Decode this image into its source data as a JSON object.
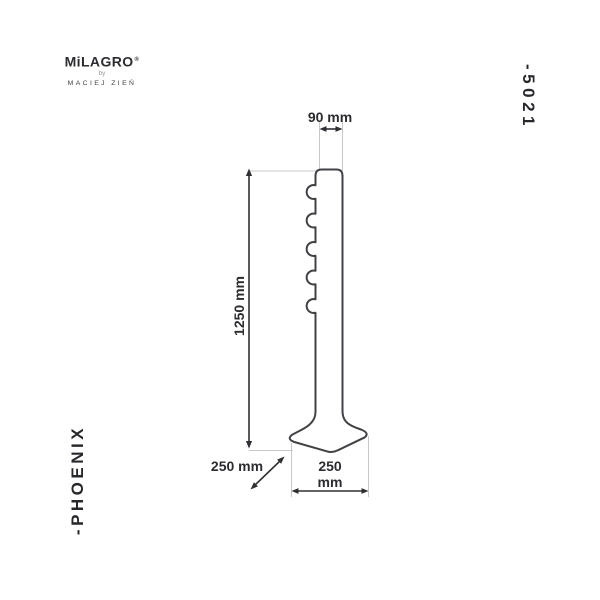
{
  "brand": {
    "name": "MiLAGRO",
    "registered": "®",
    "by": "by",
    "designer": "MACIEJ ZIEŃ"
  },
  "product": {
    "code": "-5021",
    "name": "-PHOENIX"
  },
  "drawing": {
    "type": "technical-dimension-drawing",
    "subject": "floor lamp pole with five side knobs and flared hexagonal base",
    "dim_top_width": "90 mm",
    "dim_height": "1250 mm",
    "dim_base_depth": "250 mm",
    "dim_base_width_line1": "250",
    "dim_base_width_line2": "mm"
  },
  "colors": {
    "background": "#ffffff",
    "outline": "#414146",
    "dimension_lines": "#2f3033",
    "extension_lines": "#c9c9ca",
    "text": "#27282c",
    "logo_text": "#2c2d31",
    "logo_muted": "#9a9a9e"
  }
}
